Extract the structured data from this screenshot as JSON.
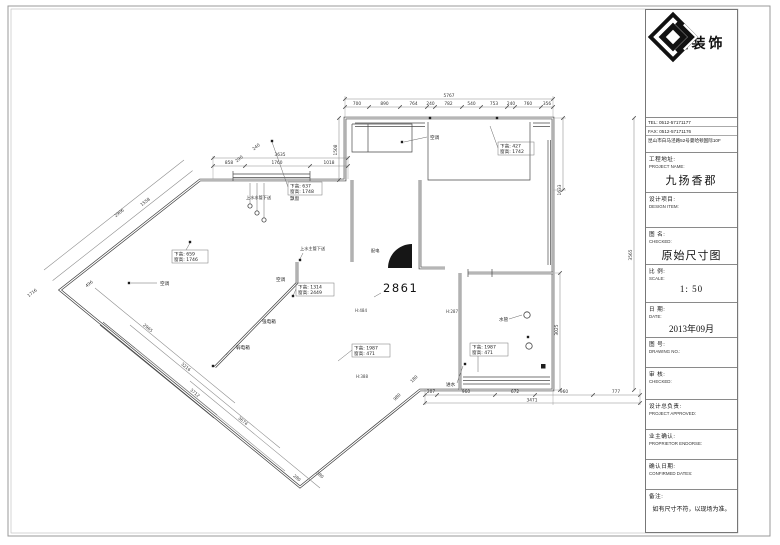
{
  "logo_company": "恒钻装饰",
  "title_block": {
    "tel": "TEL: 0512-57171177",
    "fax": "FAX: 0512-57171176",
    "address": "昆山市白马泾路52号曼哈顿国际10F",
    "rows": [
      {
        "cn": "工程地址:",
        "en": "PROJECT NAME:",
        "value": "九扬香郡"
      },
      {
        "cn": "设计项目:",
        "en": "DESIGN ITEM:",
        "value": ""
      },
      {
        "cn": "图  名:",
        "en": "CHECKED:",
        "value": "原始尺寸图"
      },
      {
        "cn": "比  例:",
        "en": "SCALE:",
        "value": "1: 50"
      },
      {
        "cn": "日  期:",
        "en": "DATE:",
        "value": "2013年09月"
      },
      {
        "cn": "图  号:",
        "en": "DRAWING NO.:",
        "value": ""
      },
      {
        "cn": "审  核:",
        "en": "CHECKED:",
        "value": ""
      },
      {
        "cn": "设计总负责:",
        "en": "PROJECT APPROVED:",
        "value": ""
      },
      {
        "cn": "业主确认:",
        "en": "PROPRIETOR ENDORSE:",
        "value": ""
      },
      {
        "cn": "确认日期:",
        "en": "CONFIRMED DATES:",
        "value": ""
      },
      {
        "cn": "备注:",
        "en": "",
        "value": "如有尺寸不符，以现场为准。"
      }
    ]
  },
  "plan": {
    "room_number": "2861",
    "dims": {
      "top_total": "5767",
      "top": [
        "700",
        "890",
        "764",
        "240",
        "782",
        "540",
        "753",
        "240",
        "760",
        "356"
      ],
      "upper_left_total": "3635",
      "upper_left": [
        "858",
        "1760",
        "1018"
      ],
      "bottom": [
        "207",
        "960",
        "672",
        "960",
        "777"
      ],
      "bottom_total": "3471",
      "diag": [
        "1558",
        "2906",
        "290",
        "240",
        "496",
        "1716",
        "2965",
        "3216",
        "3712",
        "3674",
        "280",
        "380",
        "180",
        "980"
      ],
      "vert": [
        "1508",
        "1633",
        "3025",
        "3565"
      ]
    },
    "windows": [
      {
        "l1": "下高: 637",
        "l2": "窗高: 1748",
        "note": "飘窗"
      },
      {
        "l1": "下高: 427",
        "l2": "窗高: 1742"
      },
      {
        "l1": "下高: 659",
        "l2": "窗高: 1746"
      },
      {
        "l1": "下高: 1314",
        "l2": "窗高: 2449"
      },
      {
        "l1": "下高: 1987",
        "l2": "窗高: 471"
      },
      {
        "l1": "下高: 1987",
        "l2": "窗高: 471"
      }
    ],
    "labels": {
      "ac": "空调",
      "water1": "上水水管下送",
      "water2": "上水主管下送",
      "strong": "强电箱",
      "weak": "弱电箱",
      "pipe": "水管",
      "inlet": "进水",
      "power": "配电",
      "h1": "H:484",
      "h2": "H:287",
      "h3": "H:388"
    }
  }
}
